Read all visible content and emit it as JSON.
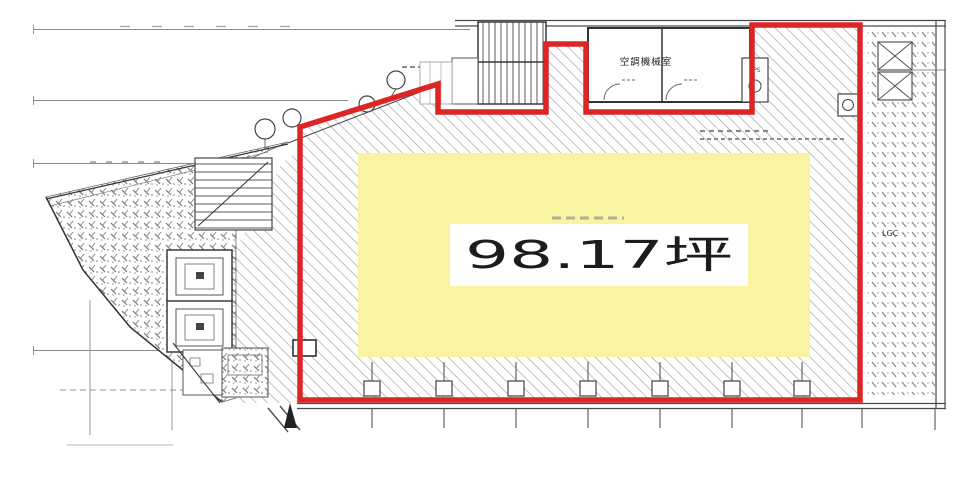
{
  "plan": {
    "area_label": "98.17坪",
    "machine_room_label": "空調機械室",
    "sps_label": "SPS",
    "lgc_label": "LGC",
    "colors": {
      "lease_outline": "#dc2525",
      "highlight": "#f8f4a2",
      "label_text": "#1c1c1c"
    }
  }
}
